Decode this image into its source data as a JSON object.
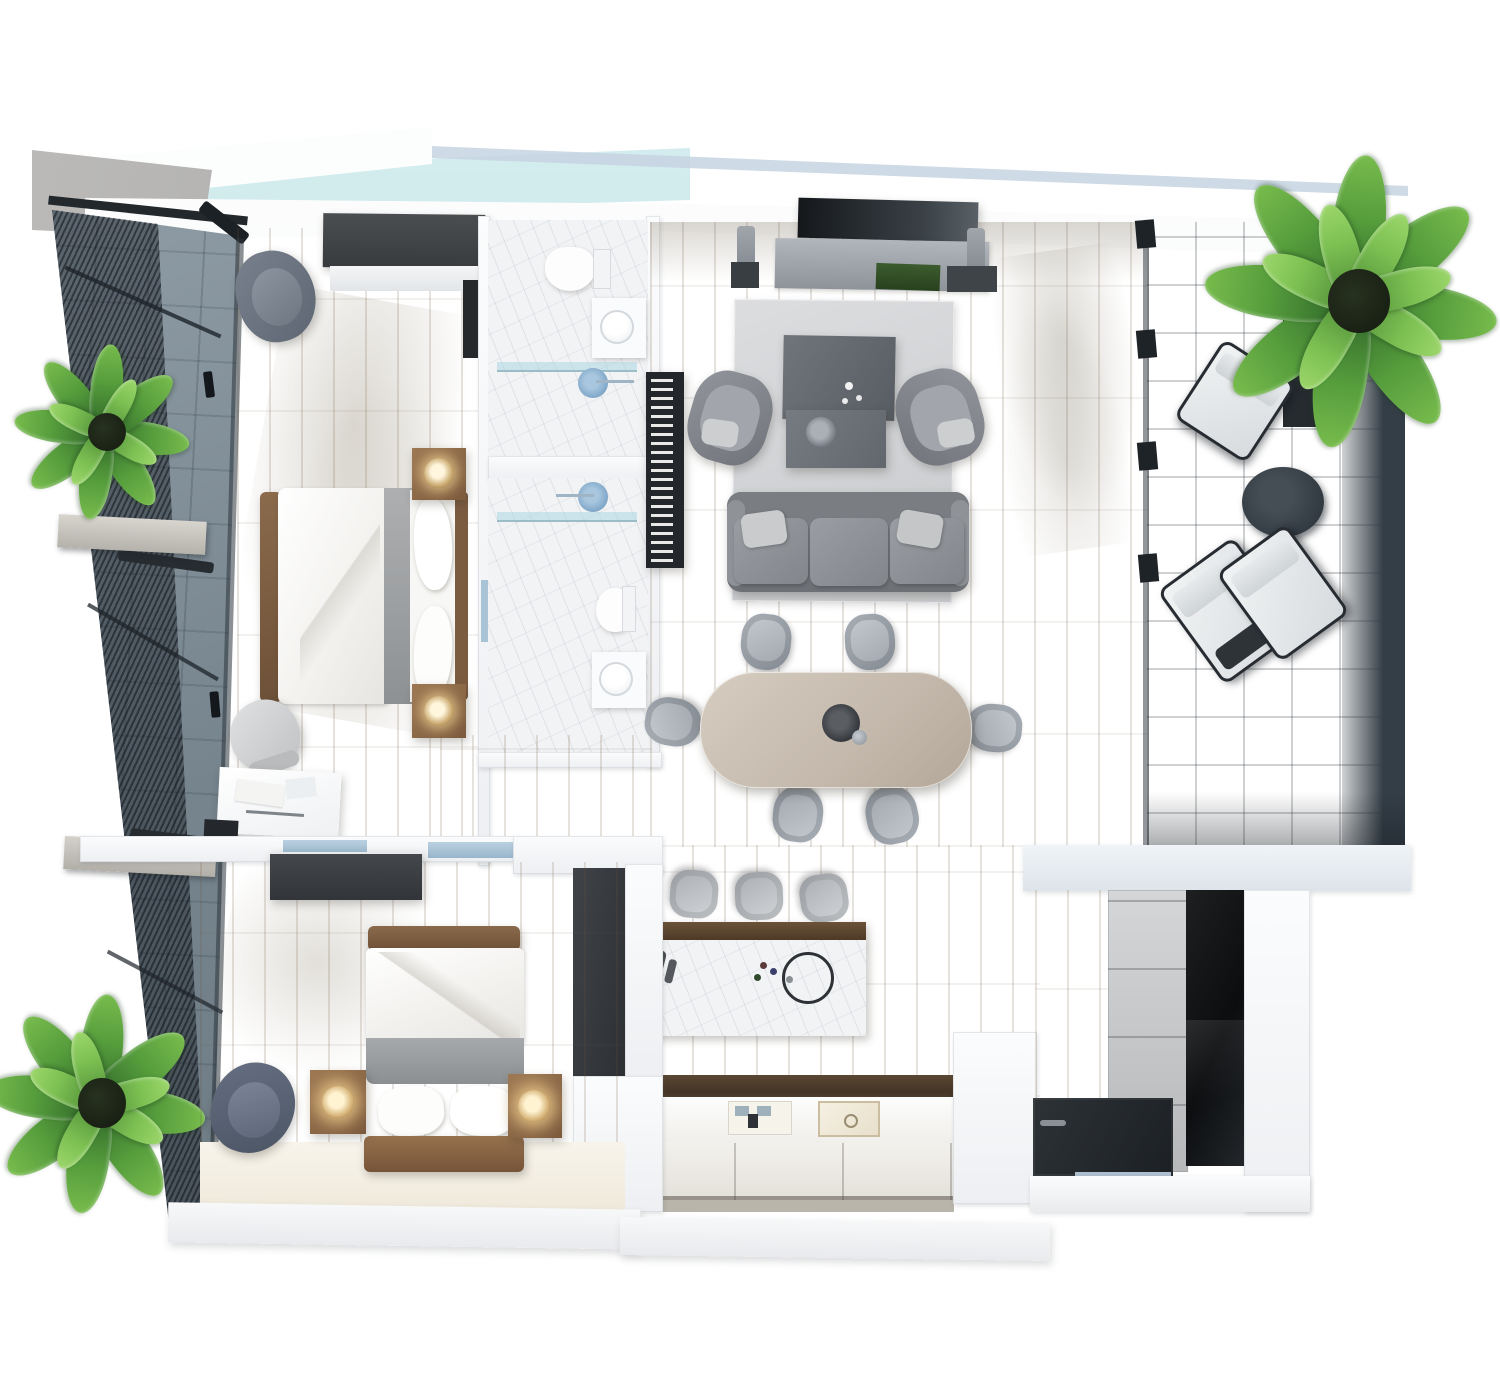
{
  "scene": {
    "kind": "3d-floor-plan-render",
    "view": "top-down",
    "style": "photoreal architectural visualization, no text labels"
  },
  "palette": {
    "background": "#ffffff",
    "wall_white": "#f4f5f7",
    "wood_floor": "#d8c5a2",
    "kitchen_wood_floor": "#c8b289",
    "balcony_slate": "#7e8c96",
    "terrace_slate": "#57656f",
    "terrace_dark_band": "#343e47",
    "marble_bathroom": "#f2f3f5",
    "skylight_glass": "#bfe2e6",
    "sofa_gray": "#84888d",
    "rug_gray": "#d4d5d7",
    "dining_table_greige": "#c7bcae",
    "chair_gray": "#9aa0a8",
    "wardrobe_dark": "#3f4245",
    "entry_cabinet_black": "#16181a",
    "bed_linen_white": "#fafafa",
    "bed_throw_gray": "#9fa2a5",
    "wood_furniture": "#8a6a4e",
    "plant_green": "#559c3c",
    "shower_head_blue": "#7fa7c9",
    "glass_door_blue": "#a9c3d6"
  },
  "counts": {
    "bedrooms": 2,
    "bathrooms": 2,
    "dining_chairs": 6,
    "bar_stools": 3,
    "terrace_lounge_chairs": 3,
    "potted_plants": 3
  },
  "rooms": [
    {
      "id": "balcony-left",
      "label": "Side balcony with mesh privacy screens",
      "floor": "slate tile",
      "items": [
        "mesh screen wall",
        "bench shelf upper",
        "bench shelf lower",
        "potted plant upper",
        "potted plant lower"
      ]
    },
    {
      "id": "master-bedroom",
      "label": "Master bedroom",
      "floor": "light wood",
      "items": [
        "wardrobe",
        "wall tv panel",
        "lounge armchair",
        "double bed with white duvet and gray throw",
        "nightstand with lamp x2",
        "writing desk",
        "office chair",
        "tablet",
        "drawer sideboard"
      ]
    },
    {
      "id": "bathroom-top",
      "label": "Bathroom 1",
      "floor": "white marble",
      "items": [
        "toilet",
        "vanity with round basin",
        "glass shower screen",
        "rain shower head",
        "sliding glass door"
      ]
    },
    {
      "id": "bathroom-bottom",
      "label": "Bathroom 2",
      "floor": "white marble",
      "items": [
        "rain shower head",
        "glass shower screen",
        "toilet",
        "vanity with round basin",
        "sliding glass door"
      ]
    },
    {
      "id": "living-room",
      "label": "Living room",
      "floor": "light wood",
      "items": [
        "wall tv",
        "media console",
        "floor speaker x2",
        "plant tray",
        "area rug",
        "two-tier coffee table with vase",
        "armchair x2",
        "three-seat sofa with pillows",
        "book shelf column"
      ]
    },
    {
      "id": "dining-area",
      "label": "Dining area",
      "floor": "light wood",
      "items": [
        "oval dining table",
        "dining chair x6",
        "centerpiece bowl"
      ]
    },
    {
      "id": "kitchen",
      "label": "Kitchen",
      "floor": "wood",
      "items": [
        "marble-front island with decor",
        "bar stool x3",
        "dark counter strip",
        "worktop with sink and cooktop",
        "base cabinets"
      ]
    },
    {
      "id": "bedroom-second",
      "label": "Second bedroom",
      "floor": "light wood with ivory rug zone",
      "items": [
        "partition wall with glass slider",
        "dark dresser",
        "double bed with wood headboard",
        "nightstand with glowing lamp x2",
        "lounge armchair",
        "tall dark wardrobe panel"
      ]
    },
    {
      "id": "terrace-right",
      "label": "Covered terrace",
      "floor": "dark slate tile",
      "items": [
        "large potted plant in dark planter",
        "lounge chair single",
        "round side table",
        "lounge chair pair",
        "sliding glass wall posts"
      ]
    },
    {
      "id": "entry",
      "label": "Entry hall",
      "floor": "wood with dark door mat",
      "items": [
        "paneled wall",
        "tall black cabinet",
        "door mat",
        "threshold strip"
      ]
    }
  ]
}
